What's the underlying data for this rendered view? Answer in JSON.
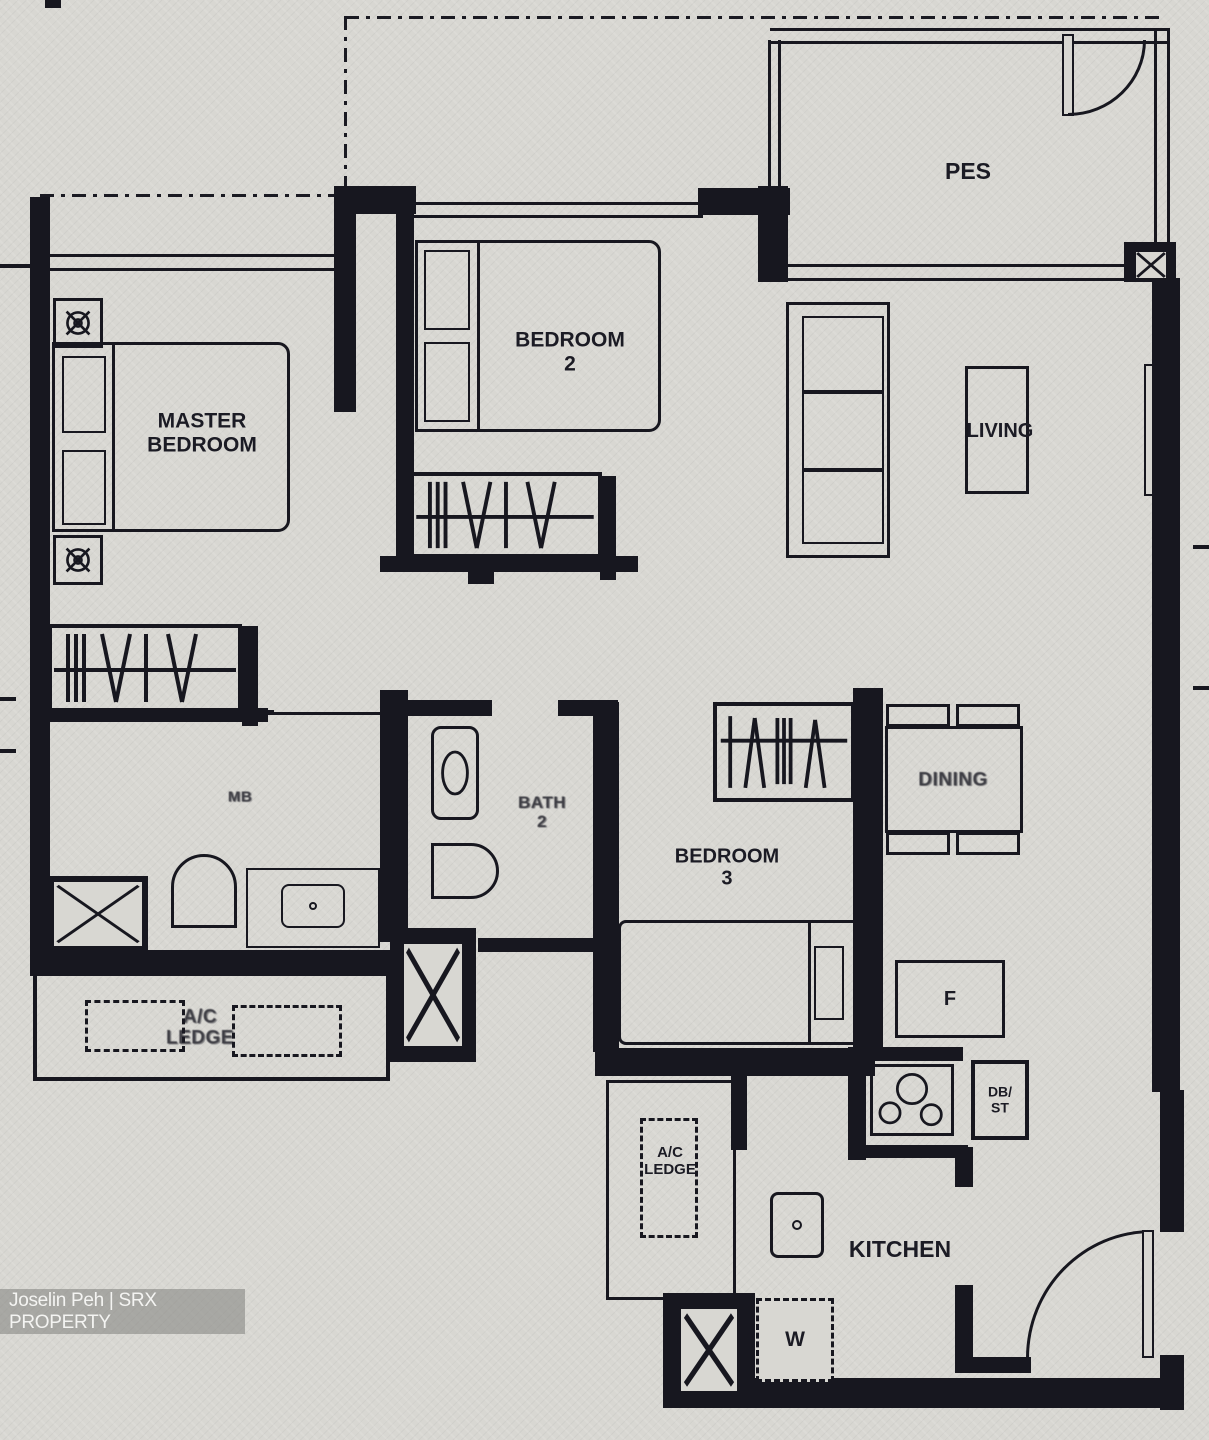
{
  "watermark": {
    "agent": "Joselin Peh | SRX PROPERTY"
  },
  "labels": {
    "pes": "PES",
    "master_bedroom_line1": "MASTER",
    "master_bedroom_line2": "BEDROOM",
    "bedroom2_line1": "BEDROOM",
    "bedroom2_line2": "2",
    "bedroom3_line1": "BEDROOM",
    "bedroom3_line2": "3",
    "living": "LIVING",
    "dining": "DINING",
    "master_bath": "MB",
    "bath2_line1": "BATH",
    "bath2_line2": "2",
    "kitchen": "KITCHEN",
    "ac_ledge_left_line1": "A/C",
    "ac_ledge_left_line2": "LEDGE",
    "ac_ledge_mid_line1": "A/C",
    "ac_ledge_mid_line2": "LEDGE",
    "fridge": "F",
    "db_st_line1": "DB/",
    "db_st_line2": "ST",
    "washer": "W"
  },
  "colors": {
    "paper": "#d8d7d2",
    "ink": "#17171f",
    "watermark_bg": "rgba(128,128,124,0.55)",
    "watermark_text": "#f4f4f2"
  }
}
